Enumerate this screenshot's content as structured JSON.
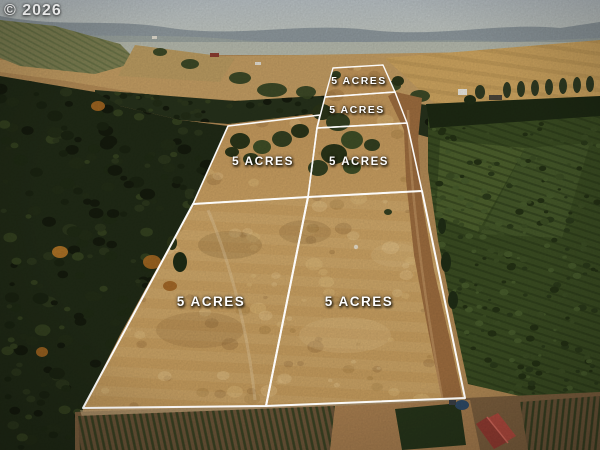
{
  "watermark": "© 2026",
  "parcels": [
    {
      "name": "back-parcel",
      "label": "5 ACRES"
    },
    {
      "name": "second-parcel",
      "label": "5 ACRES"
    },
    {
      "name": "middle-left-parcel",
      "label": "5 ACRES"
    },
    {
      "name": "middle-right-parcel",
      "label": "5 ACRES"
    },
    {
      "name": "front-left-parcel",
      "label": "5 ACRES"
    },
    {
      "name": "front-right-parcel",
      "label": "5 ACRES"
    }
  ],
  "palette": {
    "boundary_line": "#ffffff",
    "label_text": "#ffffff",
    "dry_grass": "#c99f60",
    "forest": "#222b18",
    "orchard": "#35451f",
    "dirt_road": "#9a6a3c",
    "sky_haze": "#aab3b6",
    "barn_roof": "#b0453a",
    "autumn_tree": "#b06c22"
  }
}
